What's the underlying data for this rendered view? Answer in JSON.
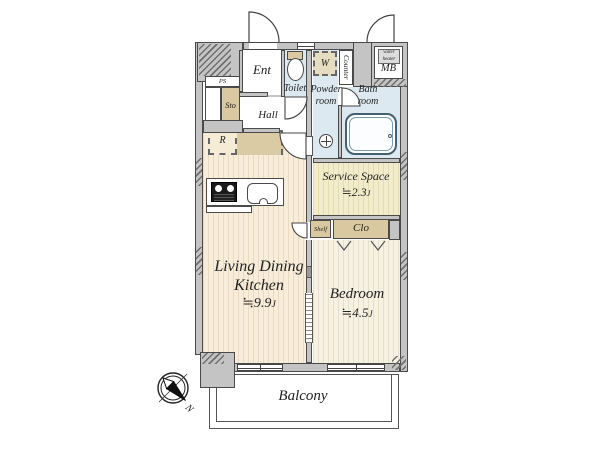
{
  "plan": {
    "entrance": {
      "label": "Ent"
    },
    "toilet": {
      "label": "Toilet"
    },
    "hall": {
      "label": "Hall"
    },
    "pipe_space": {
      "label": "PS"
    },
    "storage": {
      "label": "Sto"
    },
    "refrigerator": {
      "label": "R"
    },
    "wardrobe": {
      "label": "W"
    },
    "counter": {
      "label": "Counter"
    },
    "meter_box": {
      "label": "MB",
      "water_heater_label": "water heater"
    },
    "powder_room": {
      "label": "Powder room"
    },
    "bath_room": {
      "label": "Bath room"
    },
    "service_space": {
      "label": "Service Space",
      "area_approx": "≒2.3",
      "area_unit": "J"
    },
    "shelf": {
      "label": "Shelf"
    },
    "closet": {
      "label": "Clo"
    },
    "ldk": {
      "label": "Living Dining Kitchen",
      "area_approx": "≒9.9",
      "area_unit": "J"
    },
    "bedroom": {
      "label": "Bedroom",
      "area_approx": "≒4.5",
      "area_unit": "J"
    },
    "balcony": {
      "label": "Balcony"
    },
    "compass": {
      "north": "N"
    }
  },
  "colors": {
    "wall": "#c4c4c4",
    "outline": "#4a4a4a",
    "wet_room_floor": "#dde9f1",
    "ldk_floor": "#f8eddb",
    "bedroom_floor": "#f6f2e3",
    "service_floor": "#f2eccc",
    "storage_tan": "#d9c8a0"
  }
}
